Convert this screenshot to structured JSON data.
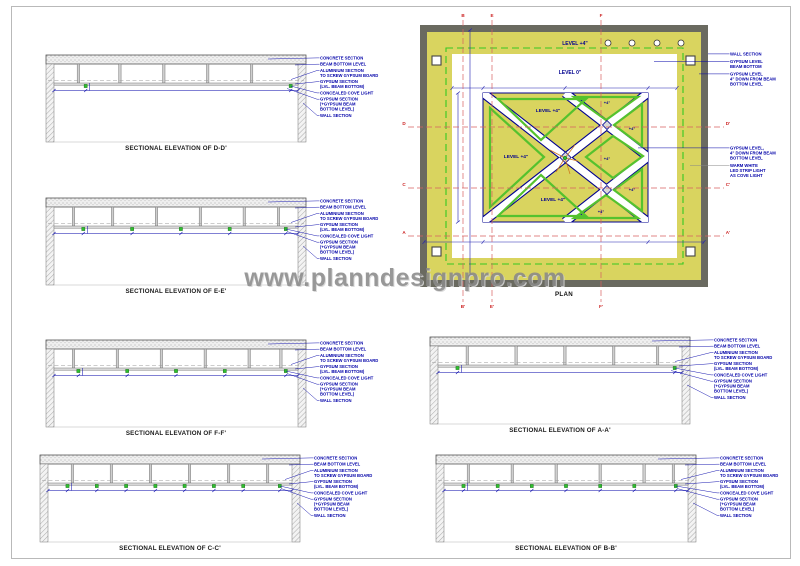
{
  "page": {
    "watermark": "www.planndesignpro.com"
  },
  "colors": {
    "annotation_blue": "#0000a8",
    "drawing_gray": "#555555",
    "cove_green": "#2ebf2e",
    "plan_yellow": "#d9d45f",
    "plan_wall_gray": "#6a6a60",
    "section_red": "#cc2222",
    "pattern_green": "#55c22e",
    "watermark_gray": "#8a8a8a"
  },
  "plan": {
    "caption": "PLAN",
    "labels": {
      "band_level": "LEVEL +4\"",
      "field_level": "LEVEL 0\"",
      "center_level": "LEVEL +4\"",
      "small_level": "+4\""
    },
    "annotations_right_top": [
      [
        "WALL SECTION"
      ],
      [
        "GYPSUM LEVEL",
        "BEAM BOTTOM"
      ],
      [
        "GYPSUM LEVEL",
        "4\" DOWN FROM BEAM",
        "BOTTOM LEVEL"
      ]
    ],
    "annotations_right_mid": [
      [
        "GYPSUM LEVEL,",
        "4\" DOWN FROM BEAM",
        "BOTTOM LEVEL"
      ],
      [
        "WARM WHITE",
        "LED STRIP LIGHT",
        "AS COVE LIGHT"
      ]
    ],
    "section_letters": {
      "top": [
        "B",
        "E",
        "F"
      ],
      "bottom": [
        "B'",
        "E'",
        "F'"
      ],
      "left": [
        "D",
        "C",
        "A"
      ],
      "right": [
        "D'",
        "C'",
        "A'"
      ]
    }
  },
  "elevations": {
    "annotations": [
      [
        "CONCRETE SECTION"
      ],
      [
        "BEAM BOTTOM LEVEL"
      ],
      [
        "ALUMINIUM SECTION",
        "TO SCREW GYPSUM BOARD"
      ],
      [
        "GYPSUM SECTION",
        "(LVL. BEAM BOTTOM)"
      ],
      [
        "CONCEALED COVE LIGHT"
      ],
      [
        "GYPSUM SECTION",
        "(+GYPSUM BEAM",
        "BOTTOM LEVEL)"
      ],
      [
        "WALL SECTION"
      ]
    ],
    "items": [
      {
        "id": "d-d",
        "caption": "SECTIONAL ELEVATION OF D-D'",
        "lights": [
          0.13,
          0.97
        ],
        "beams": [
          0.1,
          0.27,
          0.45,
          0.63,
          0.81
        ]
      },
      {
        "id": "e-e",
        "caption": "SECTIONAL ELEVATION OF E-E'",
        "lights": [
          0.12,
          0.32,
          0.52,
          0.72,
          0.95
        ],
        "beams": [
          0.08,
          0.24,
          0.42,
          0.6,
          0.78,
          0.92
        ]
      },
      {
        "id": "f-f",
        "caption": "SECTIONAL ELEVATION OF F-F'",
        "lights": [
          0.1,
          0.3,
          0.5,
          0.7,
          0.95
        ],
        "beams": [
          0.08,
          0.26,
          0.44,
          0.62,
          0.8,
          0.93
        ]
      },
      {
        "id": "a-a",
        "caption": "SECTIONAL ELEVATION OF A-A'",
        "lights": [
          0.08,
          0.97
        ],
        "beams": [
          0.12,
          0.32,
          0.52,
          0.72,
          0.9
        ]
      },
      {
        "id": "c-c",
        "caption": "SECTIONAL ELEVATION OF C-C'",
        "lights": [
          0.08,
          0.2,
          0.32,
          0.44,
          0.56,
          0.68,
          0.8,
          0.95
        ],
        "beams": [
          0.1,
          0.26,
          0.42,
          0.58,
          0.74,
          0.9
        ]
      },
      {
        "id": "b-b",
        "caption": "SECTIONAL ELEVATION OF B-B'",
        "lights": [
          0.08,
          0.22,
          0.36,
          0.5,
          0.64,
          0.78,
          0.95
        ],
        "beams": [
          0.1,
          0.28,
          0.46,
          0.64,
          0.82,
          0.94
        ]
      }
    ]
  }
}
